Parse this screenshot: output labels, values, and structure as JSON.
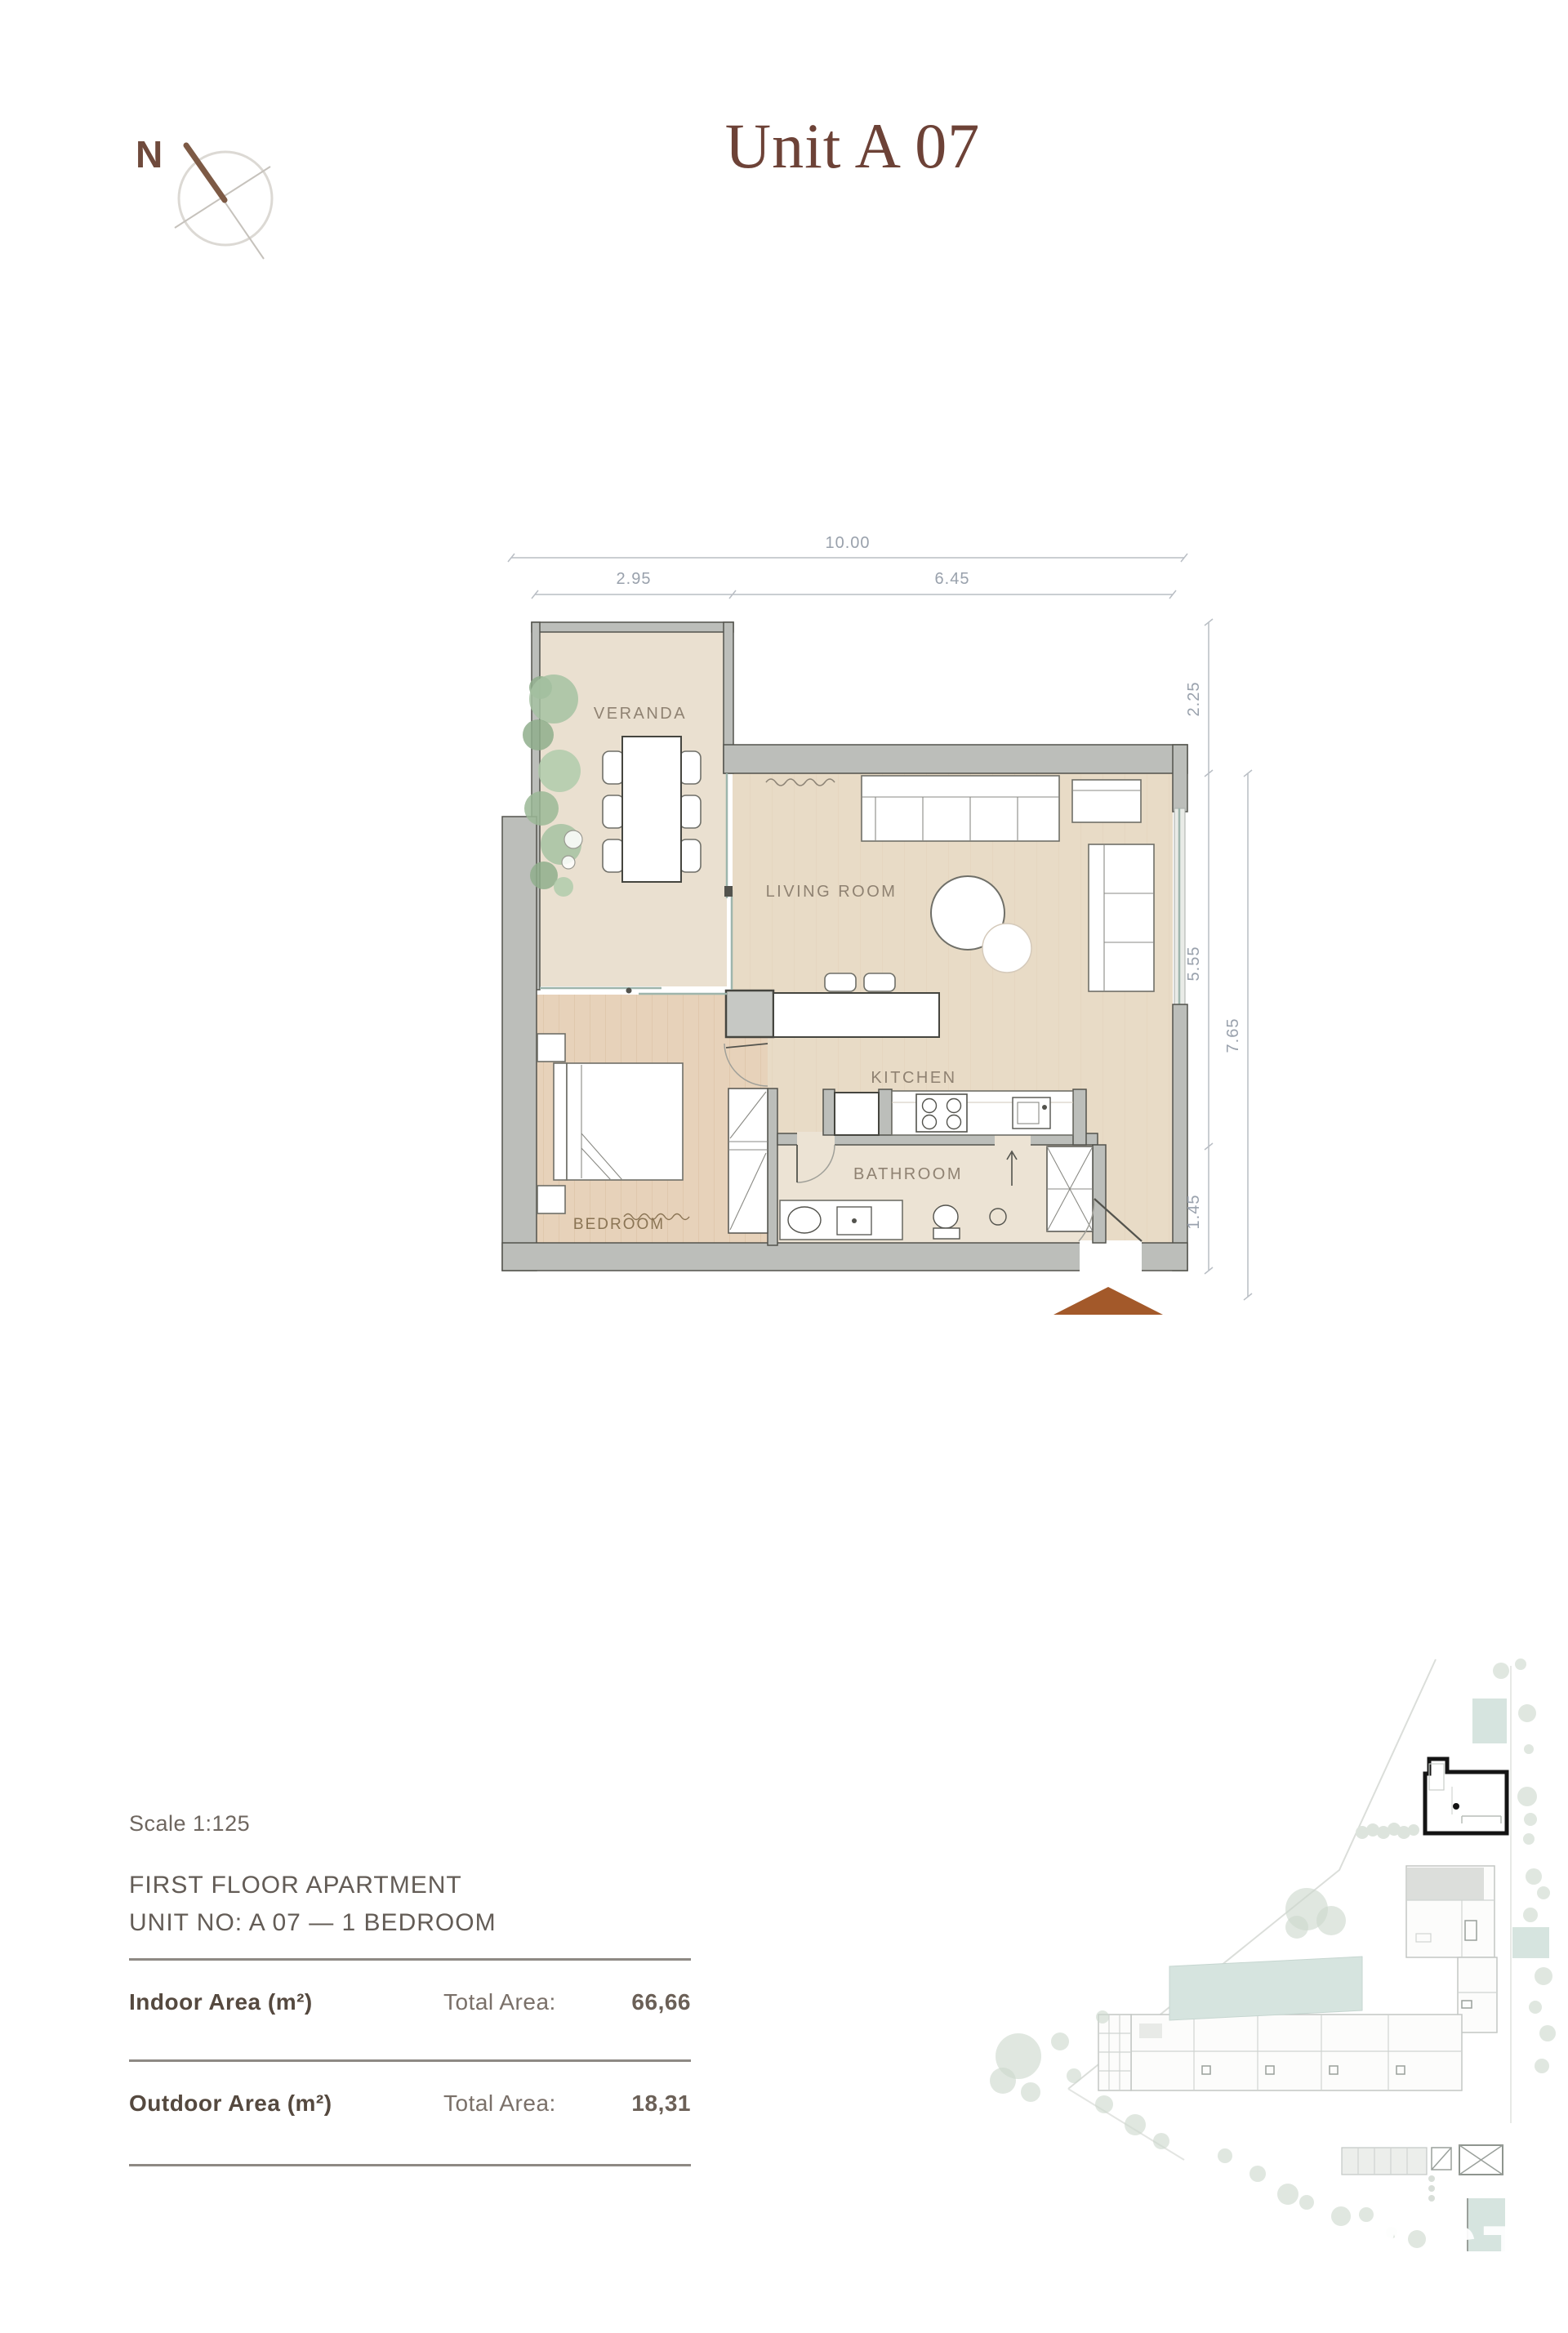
{
  "page": {
    "title": "Unit A 07"
  },
  "compass": {
    "north_label": "N"
  },
  "floor_plan": {
    "rooms": {
      "veranda": "VERANDA",
      "living_room": "LIVING ROOM",
      "kitchen": "KITCHEN",
      "bathroom": "BATHROOM",
      "bedroom": "BEDROOM"
    },
    "dimensions": {
      "total_width": "10.00",
      "veranda_width": "2.95",
      "main_width": "6.45",
      "upper_height": "2.25",
      "living_height": "5.55",
      "lower_height": "1.45",
      "total_height": "7.65"
    }
  },
  "info": {
    "scale": "Scale 1:125",
    "floor_line": "FIRST FLOOR APARTMENT",
    "unit_line": "UNIT NO: A 07 — 1 BEDROOM",
    "areas": [
      {
        "label": "Indoor Area (m²)",
        "total_label": "Total Area:",
        "value": "66,66"
      },
      {
        "label": "Outdoor Area (m²)",
        "total_label": "Total Area:",
        "value": "18,31"
      }
    ]
  },
  "watermark": {
    "line1": "KASTE",
    "line2": "IMMOBILIEN"
  },
  "colors": {
    "title_accent": "#6d4237",
    "entrance_marker": "#a3592a",
    "wall_gray": "#bcbeba",
    "floor_beige": "#e8dbc6",
    "wood_floor": "#e7d2ba",
    "glass_teal": "#9eb5ac",
    "pool_teal": "#d6e4df",
    "plant_green": "#9bb897"
  }
}
